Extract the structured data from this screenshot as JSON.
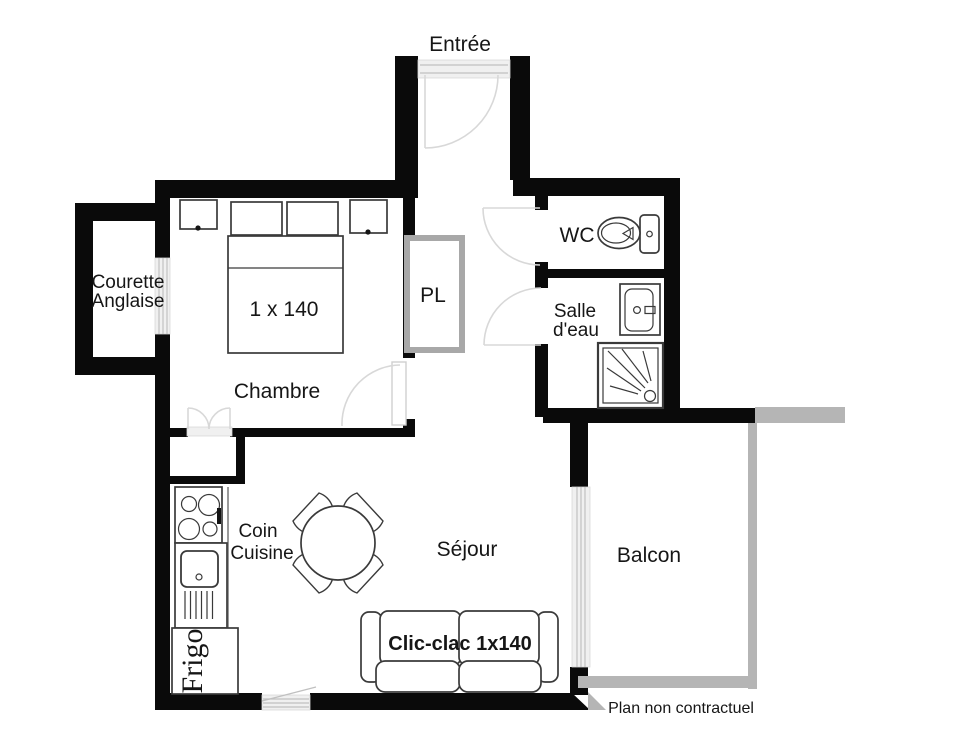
{
  "plan": {
    "disclaimer": "Plan non contractuel",
    "rooms": {
      "entree": "Entrée",
      "courette_line1": "Courette",
      "courette_line2": "Anglaise",
      "chambre": "Chambre",
      "placard": "PL",
      "wc": "WC",
      "salle_eau_line1": "Salle",
      "salle_eau_line2": "d'eau",
      "coin_cuisine_line1": "Coin",
      "coin_cuisine_line2": "Cuisine",
      "sejour": "Séjour",
      "balcon": "Balcon"
    },
    "furniture": {
      "bed_size": "1 x 140",
      "sofa_label": "Clic-clac 1x140",
      "fridge": "Frigo"
    },
    "colors": {
      "wall": "#0a0a0a",
      "railing": "#b5b5b5",
      "window_fill": "#f0f0f0",
      "door_arc": "#d8d8d8",
      "furniture_outline": "#3a3a3a",
      "background": "#ffffff"
    }
  }
}
